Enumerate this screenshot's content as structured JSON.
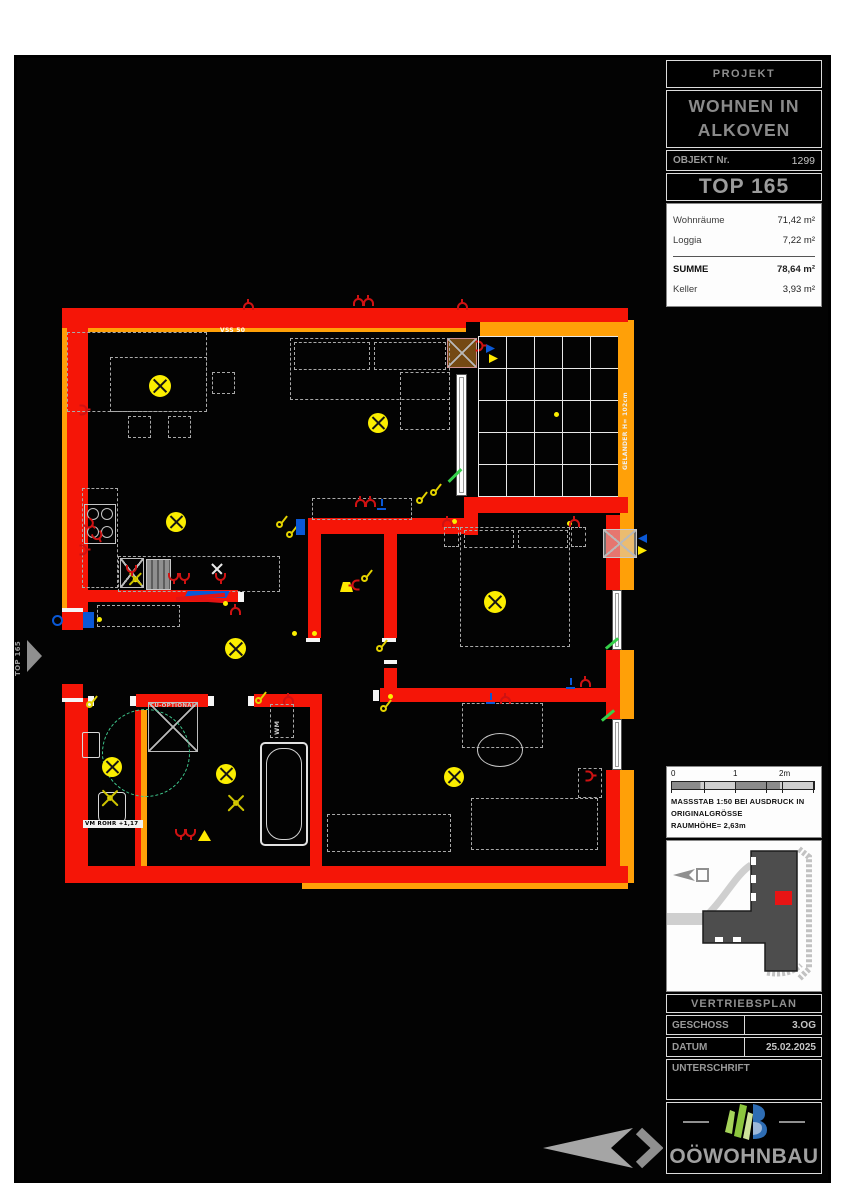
{
  "title_block": {
    "projekt_label": "PROJEKT",
    "project_name": "WOHNEN IN ALKOVEN",
    "objekt_label": "OBJEKT Nr.",
    "objekt_value": "1299",
    "unit_label": "TOP 165",
    "area_rows": [
      {
        "label": "Wohnräume",
        "value": "71,42 m²"
      },
      {
        "label": "Loggia",
        "value": "7,22 m²"
      },
      {
        "label": "SUMME",
        "value": "78,64 m²"
      },
      {
        "label": "Keller",
        "value": "3,93 m²"
      }
    ]
  },
  "scale_bar": {
    "tick0": "0",
    "tick1": "1",
    "tick2": "2m",
    "line1": "MASSSTAB 1:50 BEI AUSDRUCK IN",
    "line2": "ORIGINALGRÖSSE",
    "line3": "RAUMHÖHE= 2,63m"
  },
  "footer": {
    "plan_type": "VERTRIEBSPLAN",
    "geschoss_label": "GESCHOSS",
    "geschoss_value": "3.OG",
    "datum_label": "DATUM",
    "datum_value": "25.02.2025",
    "unterschrift_label": "UNTERSCHRIFT"
  },
  "logo": {
    "name": "OÖWOHNBAU"
  },
  "plan": {
    "labels": {
      "vss": "VSS 50",
      "gelaender": "GELÄNDER H= 102cm",
      "cu_optional": "CU-OPTIONAL",
      "wm": "WM",
      "vm_rohr": "VM ROHR +1,17",
      "entrance": "TOP 165"
    }
  },
  "colors": {
    "wall_red": "#f51507",
    "railing_orange": "#ffa008",
    "light_yellow": "#ffee00",
    "symbol_red": "#cf1212",
    "symbol_blue": "#0a58d6",
    "turning_circle_green": "#3fc98e",
    "logo_green": "#8cc63e",
    "logo_blue": "#2e6db4"
  }
}
